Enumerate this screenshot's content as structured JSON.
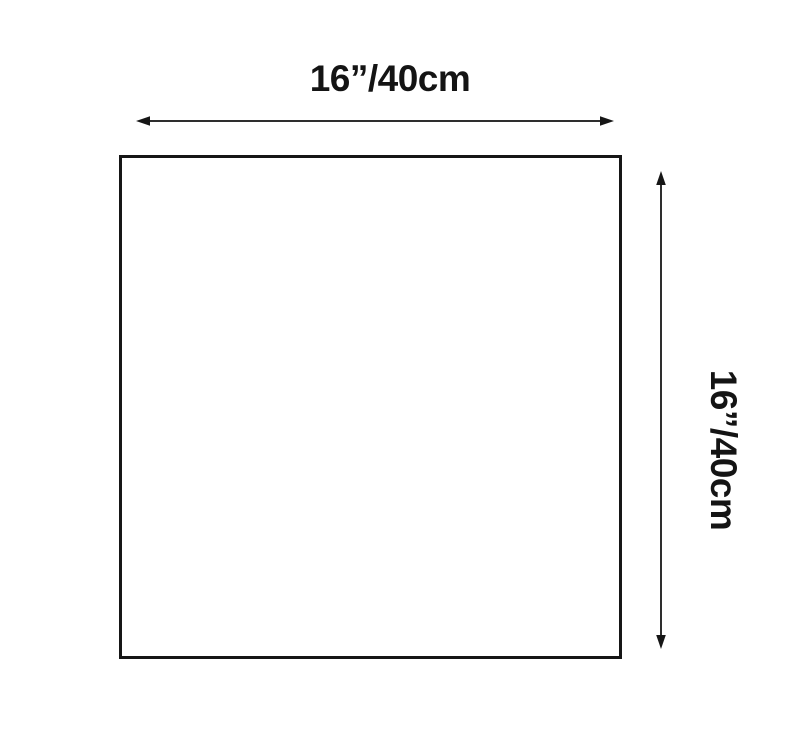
{
  "diagram": {
    "width_label": "16”/40cm",
    "height_label": "16”/40cm"
  },
  "colors": {
    "background": "#ffffff",
    "line": "#2e2e2e",
    "arrowhead": "#161616",
    "square_border": "#161616",
    "text": "#141414"
  }
}
